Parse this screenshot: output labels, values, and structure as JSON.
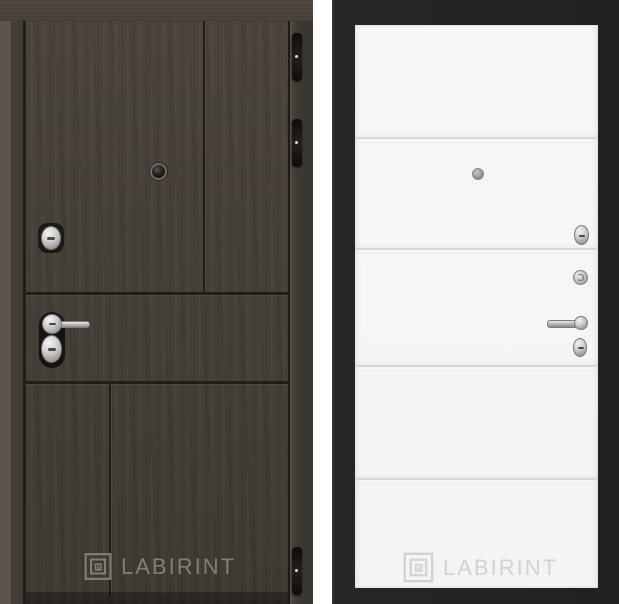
{
  "canvas": {
    "width": 619,
    "height": 604,
    "background": "#ffffff"
  },
  "brand": {
    "name": "LABIRINT",
    "logo_icon": "labyrinth-square-icon"
  },
  "doors": {
    "exterior": {
      "description": "dark wood entry door, outside face",
      "watermark": "LABIRINT",
      "colors": {
        "wood": "#46403a",
        "lintel": "#4c463f",
        "groove": "#221d18",
        "hinge": "#17130f",
        "hardware_silver": "#c9c9c9",
        "watermark_gray": "#8f8b83"
      },
      "hardware": [
        "peephole",
        "thumbturn-lock",
        "lever-handle",
        "keyhole-escutcheon",
        "hinge-top",
        "hinge-middle",
        "hinge-bottom"
      ]
    },
    "interior": {
      "description": "white panel, inside face, horizontal moldings",
      "watermark": "LABIRINT",
      "colors": {
        "panel": "#f6f6f7",
        "frame": "#232323",
        "molding": "#d8d8da",
        "hardware_silver": "#c2c2c2",
        "watermark_gray": "#d2d2d4"
      },
      "molding_count": 4,
      "hardware": [
        "peephole",
        "thumbturn-lock",
        "lock-knob",
        "lever-handle",
        "keyhole-escutcheon"
      ]
    }
  }
}
